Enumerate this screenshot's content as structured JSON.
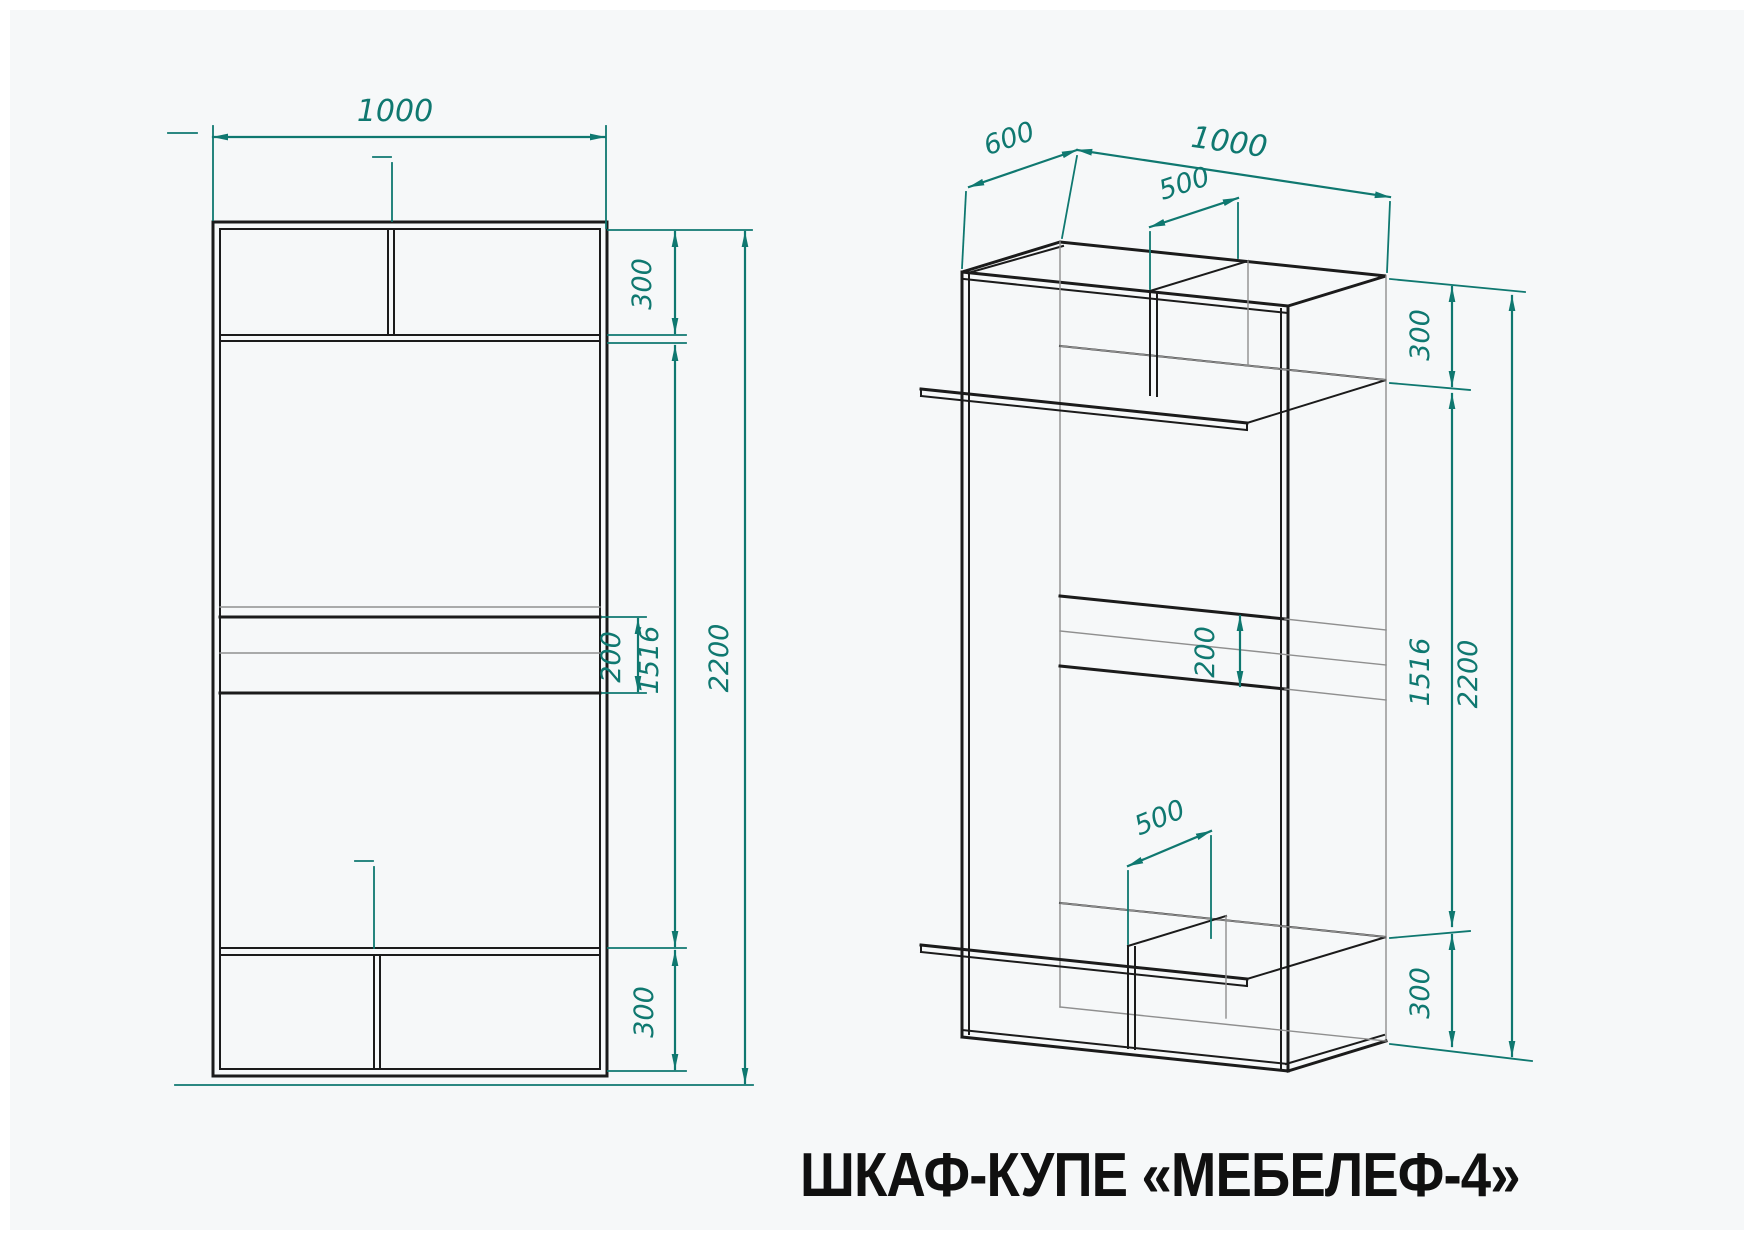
{
  "title": "ШКАФ-КУПЕ «МЕБЕЛЕФ-4»",
  "colors": {
    "dimension": "#0f7870",
    "line": "#1b1b1b",
    "thin_line": "#8f8f8f",
    "background": "#f6f8f9"
  },
  "front_view": {
    "dims": {
      "width": "1000",
      "top_section": "300",
      "drawer_height": "200",
      "middle_height": "1516",
      "total_height": "2200",
      "bottom_section": "300"
    }
  },
  "iso_view": {
    "dims": {
      "depth": "600",
      "width": "1000",
      "top_divider_offset": "500",
      "top_section": "300",
      "drawer_height": "200",
      "middle_height": "1516",
      "total_height": "2200",
      "bottom_divider_offset": "500",
      "bottom_section": "300"
    }
  }
}
